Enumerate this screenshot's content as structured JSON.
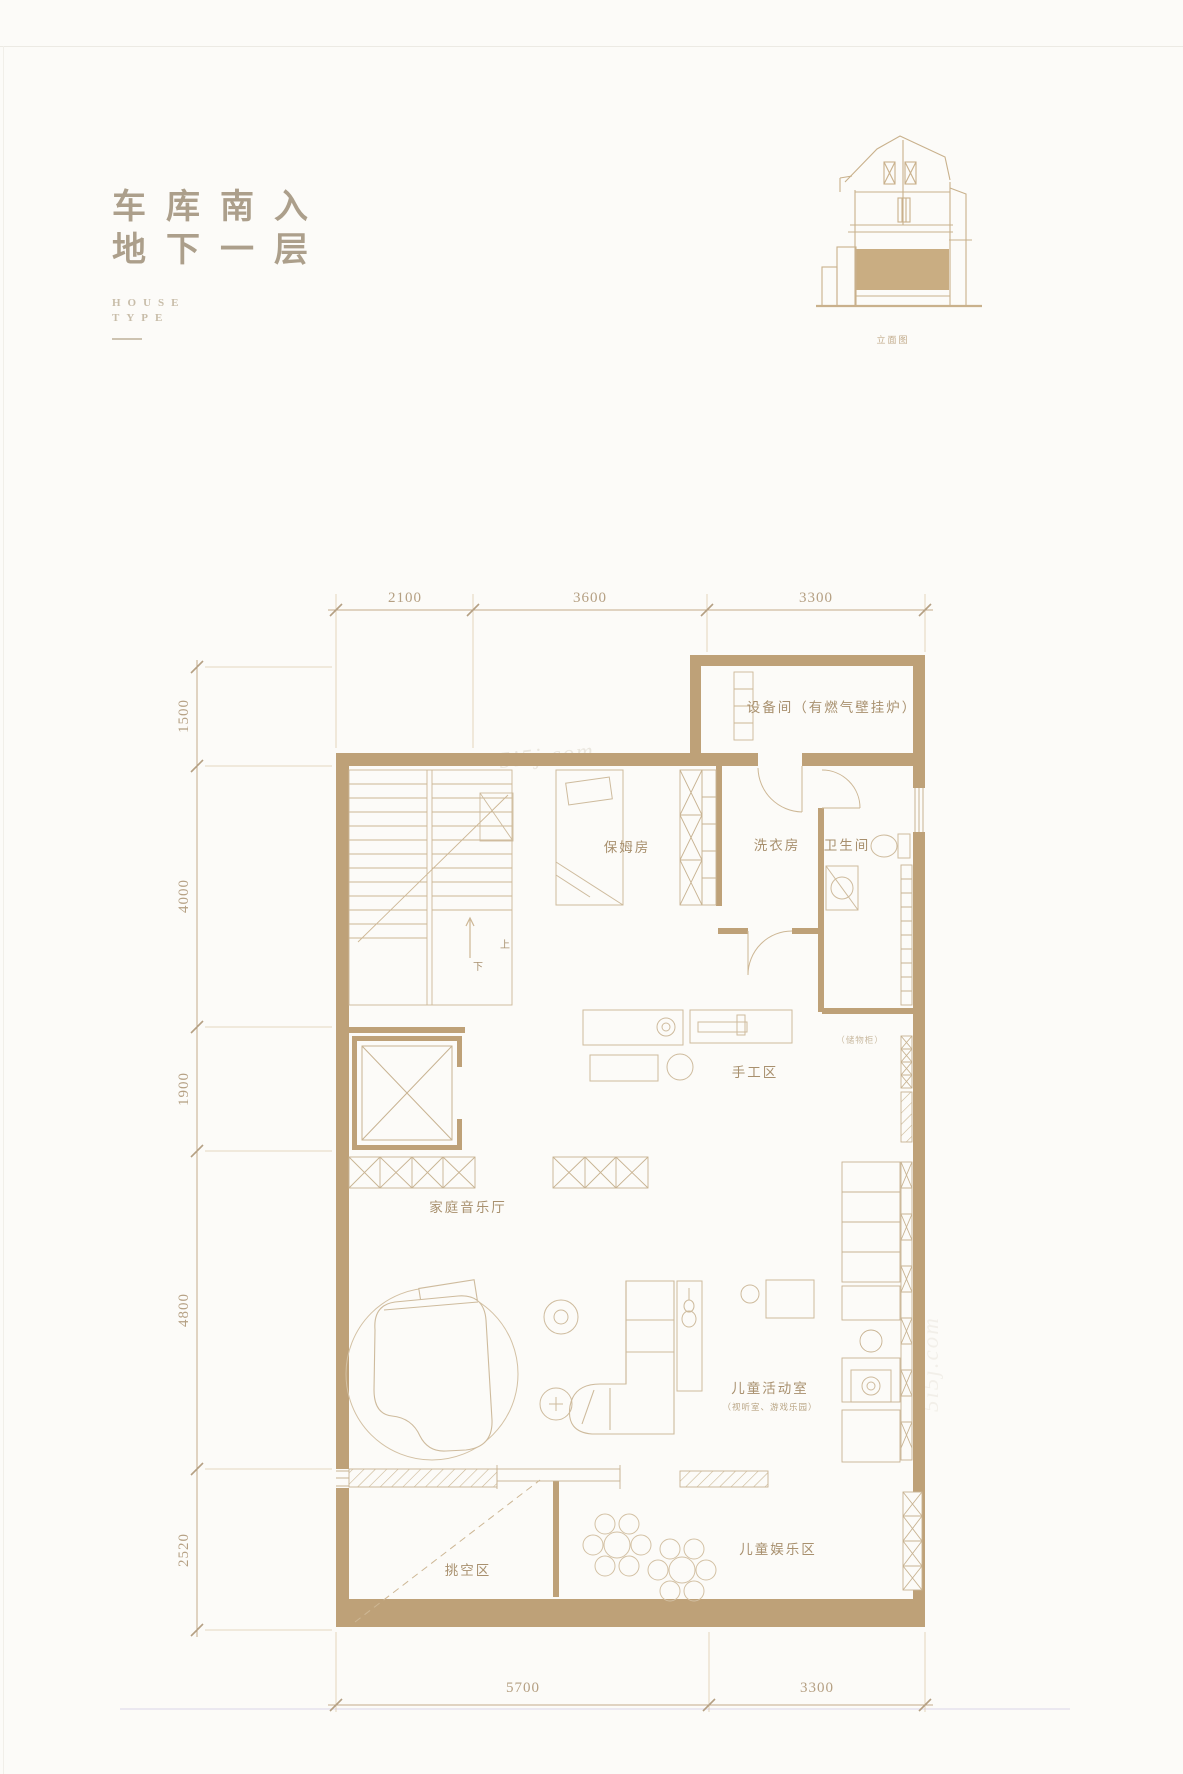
{
  "header": {
    "title_line1": "车库南入",
    "title_line2": "地下一层",
    "house_type_line1": "HOUSE",
    "house_type_line2": "TYPE"
  },
  "elevation": {
    "caption": "立面图"
  },
  "watermark": "5i5j.com",
  "dimensions": {
    "top": [
      "2100",
      "3600",
      "3300"
    ],
    "left": [
      "1500",
      "4000",
      "1900",
      "4800",
      "2520"
    ],
    "bottom": [
      "5700",
      "3300"
    ]
  },
  "rooms": {
    "equipment": "设备间（有燃气壁挂炉）",
    "nanny": "保姆房",
    "laundry": "洗衣房",
    "bathroom": "卫生间",
    "craft": "手工区",
    "cabinet_note": "（储物柜）",
    "music_hall": "家庭音乐厅",
    "kids_activity": "儿童活动室",
    "kids_activity_note": "（视听室、游戏乐园）",
    "void_area": "挑空区",
    "kids_play": "儿童娱乐区"
  },
  "stairs": {
    "up": "上",
    "down": "下"
  },
  "colors": {
    "wall": "#bea178",
    "thin_line": "#c8b392",
    "furniture_line": "#cebb9d",
    "label_text": "#a8906e",
    "dim_text": "#b5a083",
    "title_text": "#ac9f8b",
    "background": "#fcfbf8"
  }
}
